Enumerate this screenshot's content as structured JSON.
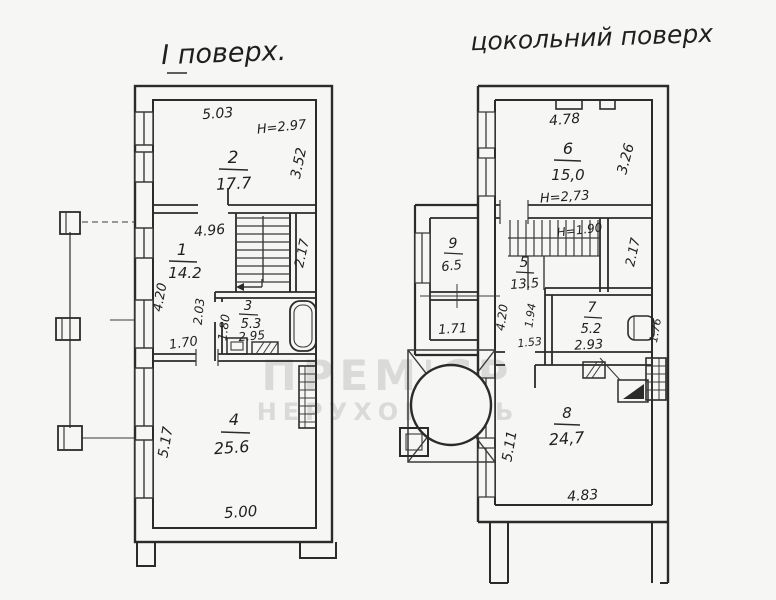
{
  "watermark": {
    "line1": "ПРЕМ'ЄР",
    "line2": "НЕРУХОМІСТЬ"
  },
  "first_floor": {
    "title": "І поверх.",
    "room2": {
      "number": "2",
      "area": "17.7",
      "width": "5.03",
      "ceiling": "Н=2.97",
      "depth": "3.52"
    },
    "room1": {
      "number": "1",
      "area": "14.2",
      "width": "4.96",
      "side": "4.20",
      "dim_a": "2.03",
      "dim_b": "1.70"
    },
    "stairs": {
      "depth": "2.17"
    },
    "room3": {
      "number": "3",
      "area": "5.3",
      "width": "2.95",
      "side": "1.80"
    },
    "room4": {
      "number": "4",
      "area": "25.6",
      "side": "5.17",
      "width": "5.00"
    }
  },
  "basement": {
    "title": "цокольний поверх",
    "room6": {
      "number": "6",
      "area": "15,0",
      "width": "4.78",
      "ceiling": "Н=2,73",
      "depth": "3.26"
    },
    "stairs": {
      "height": "Н=1.90",
      "depth": "2.17"
    },
    "room9": {
      "number": "9",
      "area": "6.5",
      "dim": "1.71"
    },
    "room5": {
      "number": "5",
      "area": "13.5",
      "side": "4.20",
      "dim_a": "1.94",
      "dim_b": "1.53"
    },
    "room7": {
      "number": "7",
      "area": "5.2",
      "width": "2.93",
      "side": "1.76"
    },
    "room8": {
      "number": "8",
      "area": "24,7",
      "side": "5.11",
      "width": "4.83"
    }
  }
}
